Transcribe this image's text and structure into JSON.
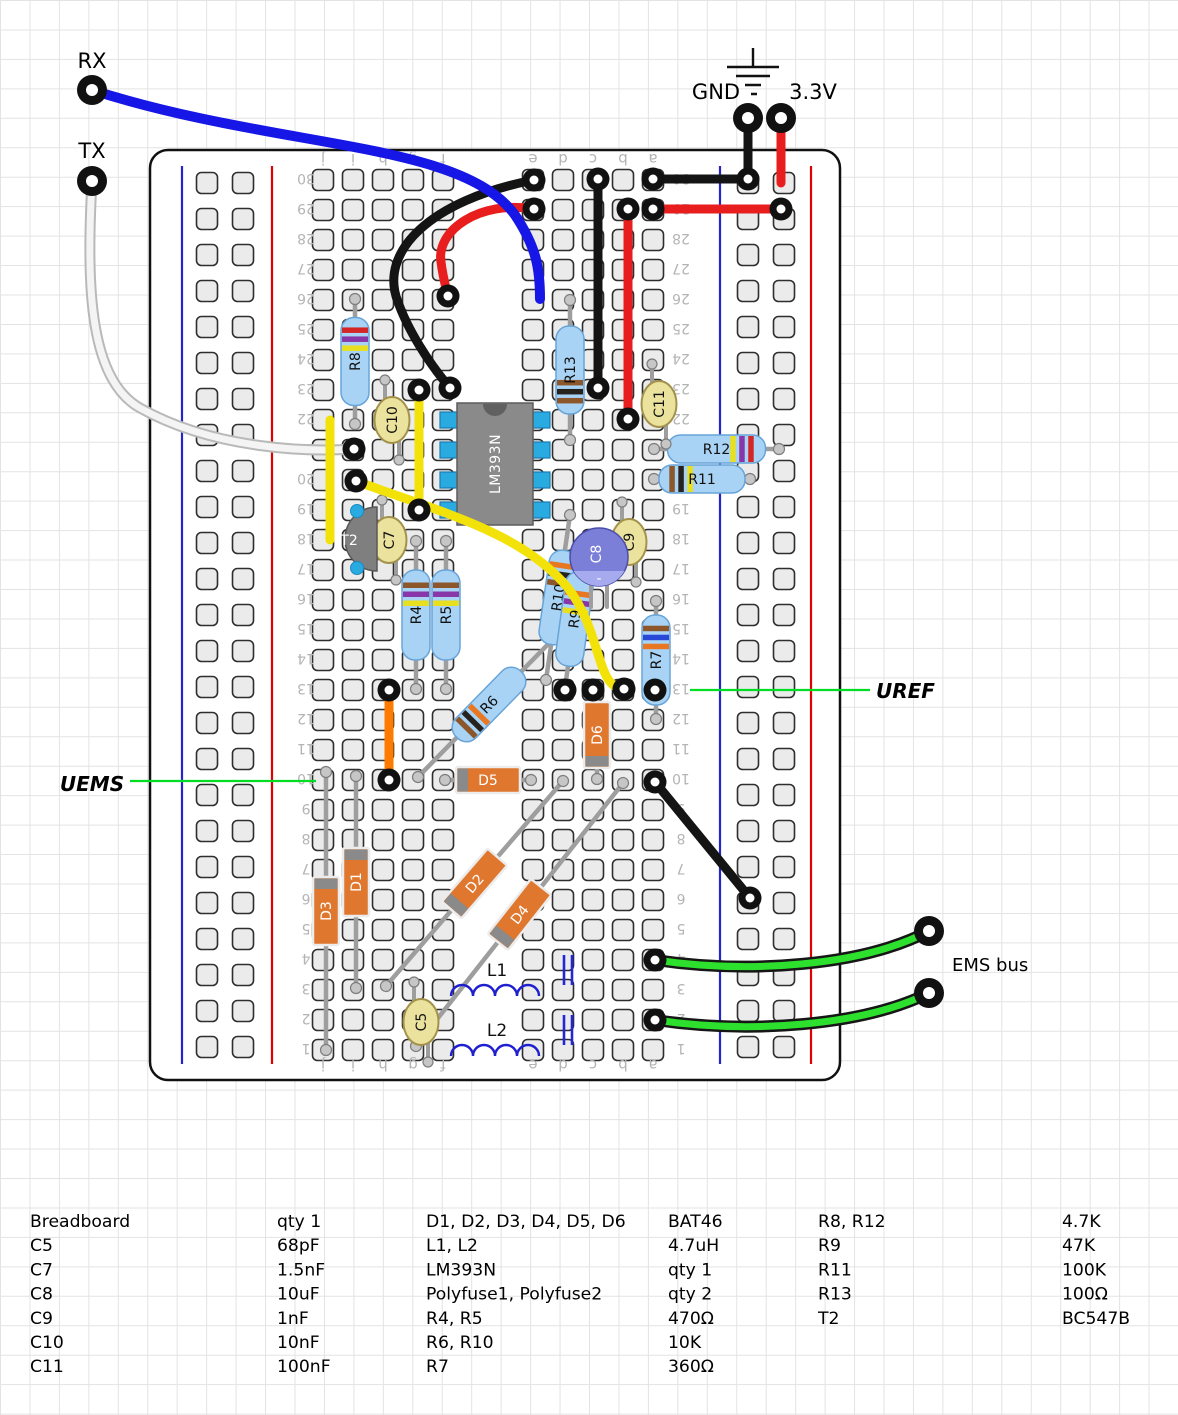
{
  "annotations": {
    "rx": "RX",
    "tx": "TX",
    "gnd": "GND",
    "v33": "3.3V",
    "uref": "UREF",
    "uems": "UEMS",
    "ems_bus": "EMS bus"
  },
  "breadboard": {
    "column_letters": [
      "j",
      "i",
      "h",
      "g",
      "f",
      "e",
      "d",
      "c",
      "b",
      "a"
    ],
    "row_min": 1,
    "row_max": 30
  },
  "pins": [
    {
      "name": "rx-pin",
      "x": 92,
      "y": 90
    },
    {
      "name": "tx-pin",
      "x": 92,
      "y": 181
    },
    {
      "name": "gnd-pin",
      "x": 748,
      "y": 118
    },
    {
      "name": "v33-pin",
      "x": 781,
      "y": 118
    },
    {
      "name": "ems-bus-pin-1",
      "x": 929,
      "y": 931
    },
    {
      "name": "ems-bus-pin-2",
      "x": 929,
      "y": 993
    }
  ],
  "wires": [
    {
      "name": "black-arc-wire",
      "color": "#141414",
      "w": 9,
      "d": "M534,180 C430,200 378,252 398,302 C408,330 428,362 450,388"
    },
    {
      "name": "red-arc-wire",
      "color": "#e81e1e",
      "w": 9,
      "d": "M534,209 C480,200 436,230 441,262 C443,278 446,288 448,296"
    },
    {
      "name": "black-column-wire",
      "color": "#141414",
      "w": 9,
      "d": "M598,179 L598,388"
    },
    {
      "name": "red-column-wire",
      "color": "#e81e1e",
      "w": 9,
      "d": "M628,209 L628,419"
    },
    {
      "name": "gnd-row-wire",
      "color": "#141414",
      "w": 9,
      "d": "M653,179 L748,179"
    },
    {
      "name": "v33-row-wire",
      "color": "#e81e1e",
      "w": 9,
      "d": "M653,209 L781,209"
    },
    {
      "name": "gnd-drop-wire",
      "color": "#141414",
      "w": 9,
      "d": "M748,118 L748,179"
    },
    {
      "name": "v33-drop-wire",
      "color": "#e81e1e",
      "w": 9,
      "d": "M781,118 L781,183"
    },
    {
      "name": "tx-white-wire",
      "color": "#f4f4f4",
      "w": 7,
      "oc": "#b9b9b9",
      "ow": 11,
      "d": "M92,181 C86,290 90,380 140,408 C215,450 310,452 354,449"
    },
    {
      "name": "yellow-wire-j",
      "color": "#f2e20a",
      "w": 9,
      "d": "M330,420 L330,540"
    },
    {
      "name": "yellow-wire-g",
      "color": "#f2e20a",
      "w": 9,
      "d": "M419,390 L419,510"
    },
    {
      "name": "yellow-curve-wire",
      "color": "#f2e20a",
      "w": 9,
      "d": "M356,481 C440,512 522,532 568,588 C602,632 596,689 624,689"
    },
    {
      "name": "orange-wire",
      "color": "#ff7a00",
      "w": 9,
      "d": "M389,690 L389,780"
    },
    {
      "name": "black-diagonal-wire",
      "color": "#141414",
      "w": 9,
      "d": "M655,782 L750,898"
    },
    {
      "name": "green-wire-1",
      "color": "#2ee02e",
      "w": 7,
      "oc": "#161616",
      "ow": 12,
      "d": "M655,960 C750,974 862,966 929,931"
    },
    {
      "name": "green-wire-2",
      "color": "#2ee02e",
      "w": 7,
      "oc": "#161616",
      "ow": 12,
      "d": "M655,1020 C750,1034 862,1026 929,993"
    },
    {
      "name": "rx-blue-wire",
      "color": "#1616e6",
      "w": 10,
      "d": "M92,90 C280,150 460,140 515,215 C537,248 540,270 540,299"
    }
  ],
  "rings": [
    [
      534,
      180
    ],
    [
      534,
      209
    ],
    [
      450,
      388
    ],
    [
      448,
      296
    ],
    [
      598,
      179
    ],
    [
      598,
      388
    ],
    [
      628,
      209
    ],
    [
      628,
      419
    ],
    [
      653,
      179
    ],
    [
      653,
      209
    ],
    [
      748,
      179
    ],
    [
      781,
      209
    ],
    [
      419,
      390
    ],
    [
      419,
      510
    ],
    [
      356,
      481
    ],
    [
      624,
      689
    ],
    [
      389,
      690
    ],
    [
      389,
      780
    ],
    [
      655,
      782
    ],
    [
      750,
      898
    ],
    [
      655,
      960
    ],
    [
      655,
      1020
    ],
    [
      354,
      449
    ],
    [
      655,
      690
    ],
    [
      565,
      690
    ],
    [
      593,
      690
    ]
  ],
  "components": {
    "ic": {
      "label": "LM393N",
      "x": 457,
      "y": 403,
      "w": 76,
      "h": 122,
      "pins": [
        420,
        450,
        480,
        510
      ],
      "body_color": "#8a8a8a",
      "pin_color": "#29abe2"
    },
    "transistor": {
      "label": "T2",
      "flat_x": 377,
      "y_top": 507,
      "y_bot": 571,
      "dots": [
        [
          357,
          511
        ],
        [
          357,
          568
        ]
      ],
      "body_color": "#7f7f7f"
    },
    "resistors": [
      {
        "label": "R8",
        "x1": 355,
        "y1": 424,
        "x2": 355,
        "y2": 299,
        "body": 88,
        "bp": 0.62,
        "bands": [
          "#e8df20",
          "#8836a8",
          "#d42626"
        ]
      },
      {
        "label": "R13",
        "x1": 570,
        "y1": 440,
        "x2": 570,
        "y2": 300,
        "body": 88,
        "bp": 0.12,
        "bands": [
          "#8b572b",
          "#26221e",
          "#8b572b"
        ]
      },
      {
        "label": "R4",
        "x1": 416,
        "y1": 689,
        "x2": 416,
        "y2": 541,
        "body": 90,
        "bp": 0.6,
        "bands": [
          "#e8df20",
          "#8836a8",
          "#8b572b"
        ]
      },
      {
        "label": "R5",
        "x1": 446,
        "y1": 689,
        "x2": 446,
        "y2": 541,
        "body": 90,
        "bp": 0.6,
        "bands": [
          "#e8df20",
          "#8836a8",
          "#8b572b"
        ]
      },
      {
        "label": "R7",
        "x1": 656,
        "y1": 719,
        "x2": 656,
        "y2": 601,
        "body": 90,
        "bp": 0.62,
        "bands": [
          "#e87722",
          "#2848d8",
          "#8b572b"
        ]
      },
      {
        "label": "R12",
        "x1": 654,
        "y1": 449,
        "x2": 779,
        "y2": 449,
        "body": 98,
        "bp": 0.64,
        "bands": [
          "#e8df20",
          "#8836a8",
          "#d42626"
        ]
      },
      {
        "label": "R11",
        "x1": 654,
        "y1": 479,
        "x2": 750,
        "y2": 479,
        "body": 86,
        "bp": 0.12,
        "bands": [
          "#8b572b",
          "#26221e",
          "#e8df20"
        ]
      },
      {
        "label": "R6",
        "x1": 418,
        "y1": 777,
        "x2": 560,
        "y2": 632,
        "body": 92,
        "bp": 0.12,
        "bands": [
          "#8b572b",
          "#26221e",
          "#e87722"
        ]
      },
      {
        "label": "R10",
        "x1": 546,
        "y1": 680,
        "x2": 570,
        "y2": 515,
        "body": 95,
        "bp": 0.62,
        "bands": [
          "#8b572b",
          "#26221e",
          "#e87722"
        ]
      },
      {
        "label": "R9",
        "x1": 565,
        "y1": 688,
        "x2": 584,
        "y2": 550,
        "body": 95,
        "bp": 0.55,
        "bands": [
          "#e8df20",
          "#8836a8",
          "#e87722"
        ]
      }
    ],
    "diodes": [
      {
        "label": "D1",
        "x1": 356,
        "y1": 988,
        "x2": 356,
        "y2": 776,
        "body": 68,
        "stripe": "end"
      },
      {
        "label": "D3",
        "x1": 326,
        "y1": 1050,
        "x2": 326,
        "y2": 772,
        "body": 68,
        "stripe": "end"
      },
      {
        "label": "D5",
        "x1": 445,
        "y1": 780,
        "x2": 531,
        "y2": 780,
        "body": 64,
        "stripe": "start"
      },
      {
        "label": "D6",
        "x1": 597,
        "y1": 779,
        "x2": 597,
        "y2": 691,
        "body": 66,
        "stripe": "start"
      },
      {
        "label": "D2",
        "x1": 386,
        "y1": 986,
        "x2": 563,
        "y2": 781,
        "body": 70,
        "stripe": "start"
      },
      {
        "label": "D4",
        "x1": 416,
        "y1": 1046,
        "x2": 623,
        "y2": 783,
        "body": 70,
        "stripe": "start"
      }
    ],
    "capacitors": [
      {
        "label": "C10",
        "x": 392,
        "y": 420
      },
      {
        "label": "C7",
        "x": 389,
        "y": 540
      },
      {
        "label": "C9",
        "x": 629,
        "y": 542
      },
      {
        "label": "C11",
        "x": 659,
        "y": 404
      },
      {
        "label": "C5",
        "x": 421,
        "y": 1022
      }
    ],
    "electrolytic": {
      "label": "C8",
      "x": 599,
      "y": 557,
      "r": 29,
      "color": "#7b7fd8",
      "stripe_color": "#a6aaee"
    },
    "inductors": [
      {
        "label": "L1",
        "x": 451,
        "y": 996,
        "lx": 497,
        "ly": 976
      },
      {
        "label": "L2",
        "x": 451,
        "y": 1056,
        "lx": 497,
        "ly": 1036
      }
    ],
    "polyfuses": [
      {
        "name": "polyfuse-1",
        "x": 564,
        "y1": 955,
        "y2": 985
      },
      {
        "name": "polyfuse-2",
        "x": 564,
        "y1": 1015,
        "y2": 1045
      }
    ]
  },
  "callouts": {
    "uref_line": {
      "x1": 690,
      "y1": 690,
      "x2": 870,
      "y2": 690
    },
    "uems_line": {
      "x1": 130,
      "y1": 781,
      "x2": 316,
      "y2": 781
    },
    "line_color": "#00dd22"
  },
  "bom": {
    "groups": [
      [
        {
          "name": "Breadboard",
          "value": "qty 1"
        },
        {
          "name": "C5",
          "value": "68pF"
        },
        {
          "name": "C7",
          "value": "1.5nF"
        },
        {
          "name": "C8",
          "value": "10uF"
        },
        {
          "name": "C9",
          "value": "1nF"
        },
        {
          "name": "C10",
          "value": "10nF"
        },
        {
          "name": "C11",
          "value": "100nF"
        }
      ],
      [
        {
          "name": "D1, D2, D3, D4, D5, D6",
          "value": "BAT46"
        },
        {
          "name": "L1, L2",
          "value": "4.7uH"
        },
        {
          "name": "LM393N",
          "value": "qty 1"
        },
        {
          "name": "Polyfuse1, Polyfuse2",
          "value": "qty 2"
        },
        {
          "name": "R4, R5",
          "value": "470Ω"
        },
        {
          "name": "R6, R10",
          "value": "10K"
        },
        {
          "name": "R7",
          "value": "360Ω"
        }
      ],
      [
        {
          "name": "R8, R12",
          "value": "4.7K"
        },
        {
          "name": "R9",
          "value": "47K"
        },
        {
          "name": "R11",
          "value": "100K"
        },
        {
          "name": "R13",
          "value": "100Ω"
        },
        {
          "name": "T2",
          "value": "BC547B"
        }
      ]
    ]
  }
}
